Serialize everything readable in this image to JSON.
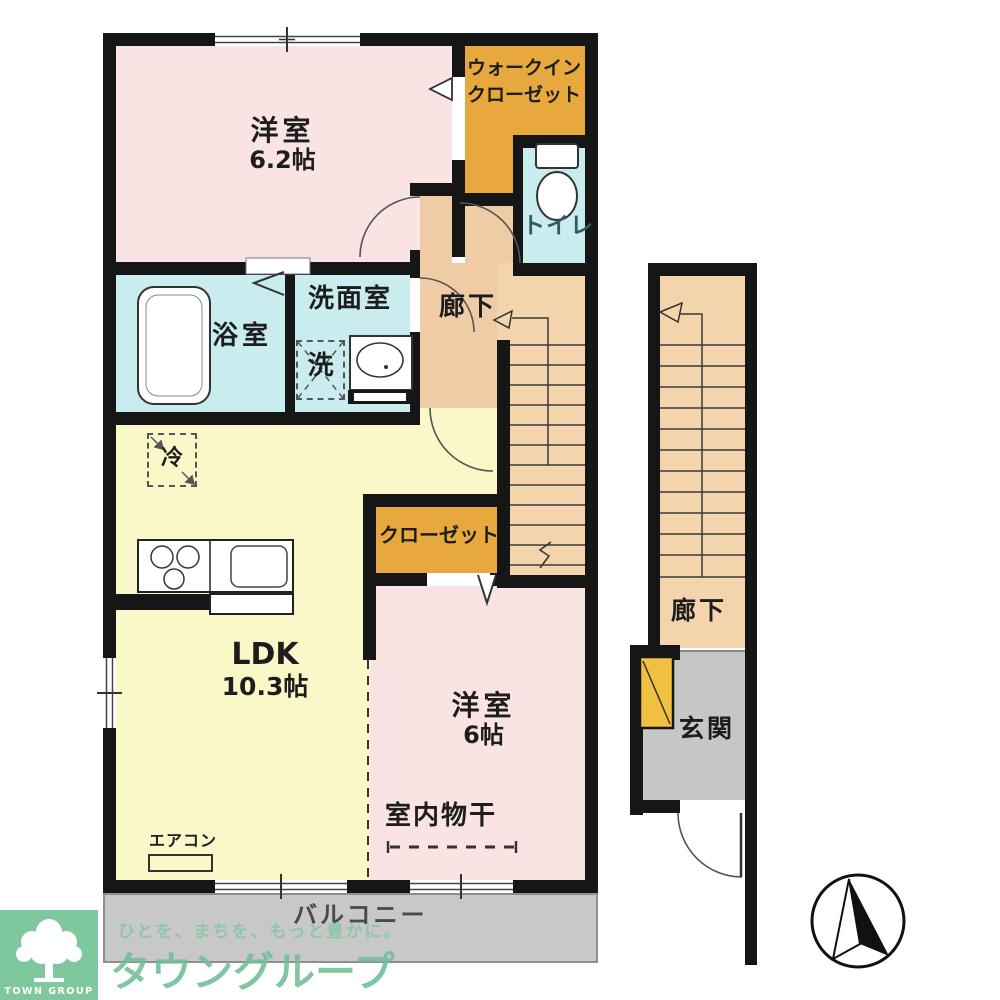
{
  "rooms": {
    "bedroom_62": {
      "name": "洋室",
      "size": "6.2帖"
    },
    "wic": {
      "line1": "ウォークイン",
      "line2": "クローゼット"
    },
    "toilet": {
      "label": "トイレ"
    },
    "bath": {
      "label": "浴室"
    },
    "washroom": {
      "label": "洗面室"
    },
    "laundry": {
      "label": "洗"
    },
    "hallway": {
      "label": "廊下"
    },
    "fridge": {
      "label": "冷"
    },
    "ldk": {
      "name": "LDK",
      "size": "10.3帖"
    },
    "closet": {
      "label": "クローゼット"
    },
    "bedroom_6": {
      "name": "洋室",
      "size": "6帖"
    },
    "indoor_drying": {
      "label": "室内物干"
    },
    "aircon": {
      "label": "エアコン"
    },
    "balcony": {
      "label": "バルコニー"
    },
    "stair_hallway": {
      "label": "廊下"
    },
    "entrance": {
      "label": "玄関"
    }
  },
  "watermark": {
    "tagline": "ひとを、まちを、もっと豊かに。",
    "brand": "タウングループ",
    "logo_caption": "TOWN GROUP"
  },
  "palette": {
    "wall": "#161616",
    "bedroom_pink": "#F9E3E3",
    "ldk_yellow": "#FAF7C8",
    "wet_cyan": "#C9ECEF",
    "closet_orange": "#E7A93E",
    "hallway_peach": "#EFCBA6",
    "stairs_peach": "#F3D4AC",
    "balcony_gray": "#C8C8C8",
    "shoebox_yellow": "#F0C040",
    "logo_green": "#7FC79D",
    "watermark_green": "#70BF97"
  }
}
